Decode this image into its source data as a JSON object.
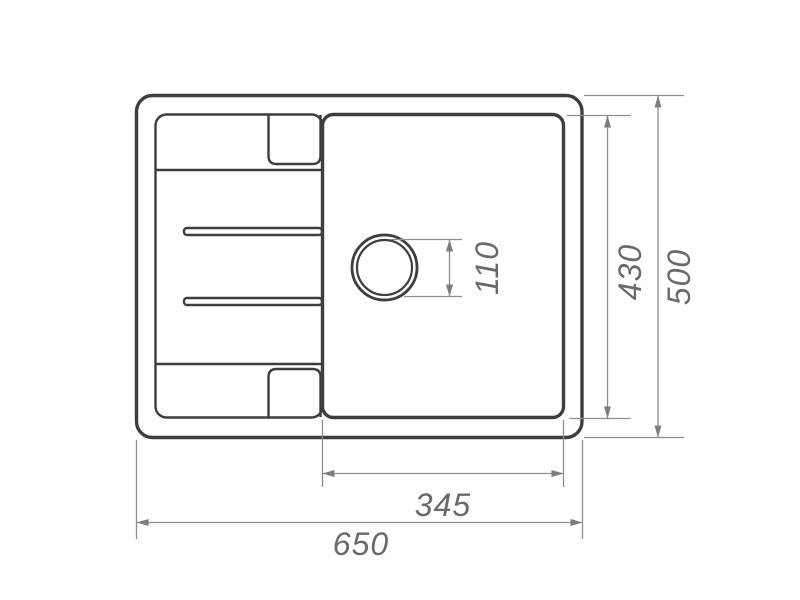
{
  "drawing": {
    "type": "technical-drawing-top-view",
    "subject": "kitchen sink with drainboard, single bowl and drain hole",
    "units_shown": "none (plain numbers, millimeters implied)",
    "dimensions": {
      "overall_width": "650",
      "overall_depth": "500",
      "bowl_depth": "430",
      "bowl_width": "345",
      "drain_diameter": "110"
    },
    "colors": {
      "outline": "#3e3e40",
      "dim_line": "#8e8e8e",
      "dim_arrow": "#7d7d7d",
      "dim_text": "#6a6a6a",
      "background": "#ffffff"
    }
  }
}
